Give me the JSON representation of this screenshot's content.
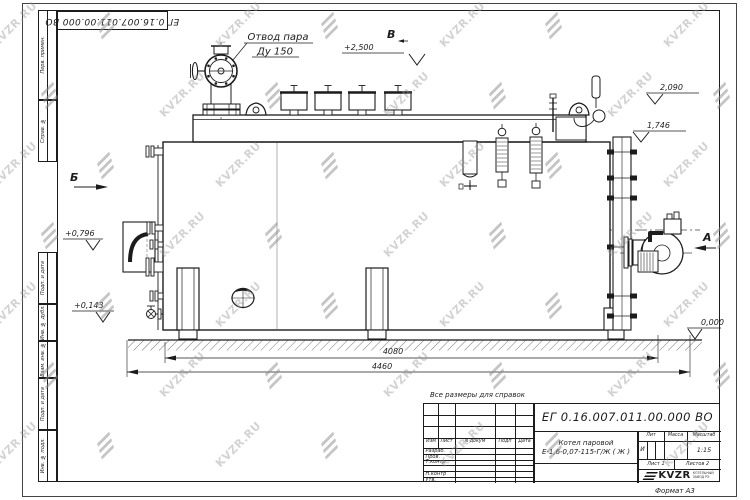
{
  "stamp": {
    "doc_number": "ЕГ 0.16.007.011.00.000  ВО"
  },
  "frame": {
    "cells": [
      {
        "label": "Перв. примен."
      },
      {
        "label": "Справ. №"
      },
      {
        "label": "Подп. и дата"
      },
      {
        "label": "Инв. № дубл."
      },
      {
        "label": "Взам. инв. №"
      },
      {
        "label": "Подп. и дата"
      },
      {
        "label": "Инв. № подл."
      }
    ]
  },
  "drawing": {
    "callout": {
      "line1": "Отвод пара",
      "line2": "Ду 150"
    },
    "views": {
      "left": "Б",
      "top": "В",
      "right": "А"
    },
    "elevations": {
      "steam_top": "+2,500",
      "right_upper": "2,090",
      "right_lower": "1,746",
      "left_upper": "+0,796",
      "left_lower": "+0,143",
      "ground": "0,000"
    },
    "dimensions": {
      "base_length": "4080",
      "overall_length": "4460"
    }
  },
  "note": "Все размеры для справок",
  "title_block": {
    "doc_number": "ЕГ 0.16.007.011.00.000  ВО",
    "product_line1": "Котел паровой",
    "product_line2": "Е-1,6-0,07-115-Г/Ж ( Ж )",
    "columns": {
      "izm": "Изм",
      "list": "Лист",
      "n_dokum": "N докум",
      "podp": "Подп",
      "data": "Дата"
    },
    "rows": {
      "razrab": "Разраб.",
      "prov": "Пров.",
      "tkontr": "Т.контр",
      "nkontr": "Н.контр",
      "utv": "Утв."
    },
    "lit_label": "Лит",
    "lit_value": "И",
    "massa_label": "Масса",
    "masshtab_label": "Масштаб",
    "masshtab_value": "1:15",
    "list_label": "Лист",
    "list_value": "1",
    "listov_label": "Листов",
    "listov_value": "2",
    "format": "Формат А3",
    "logo": {
      "brand": "KVZR",
      "sub1": "КОТЕЛЬНЫЙ",
      "sub2": "ЗАВОД РЭ"
    }
  },
  "watermark": {
    "text": "KVZR.RU"
  }
}
